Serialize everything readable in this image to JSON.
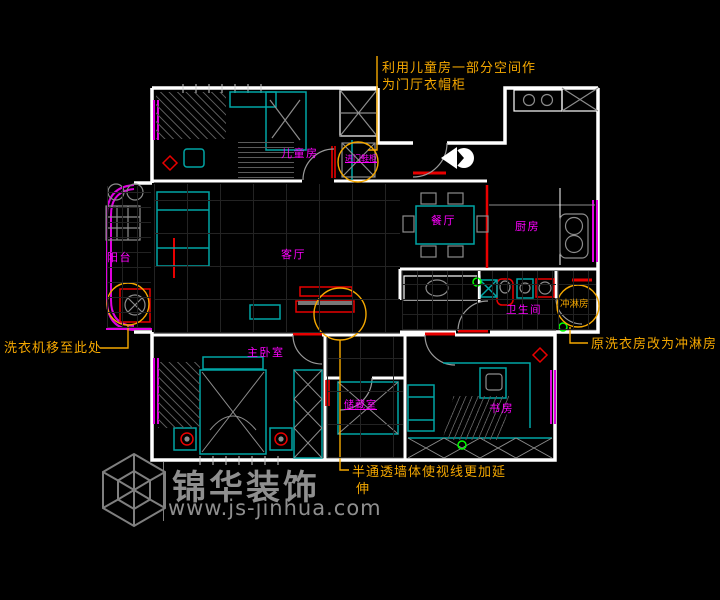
{
  "rooms": {
    "children": "儿童房",
    "shoe_cabinet": "进门鞋柜",
    "dining": "餐厅",
    "kitchen": "厨房",
    "living": "客厅",
    "balcony": "阳台",
    "master": "主卧室",
    "storage": "储藏室",
    "study": "书房",
    "bathroom": "卫生间",
    "shower": "冲淋房"
  },
  "annotations": {
    "wardrobe": {
      "line1": "利用儿童房一部分空间作",
      "line2": "为门厅衣帽柜"
    },
    "washer": "洗衣机移至此处",
    "shower_note": "原洗衣房改为冲淋房",
    "wall": {
      "line1": "半通透墙体使视线更加延",
      "line2": "伸"
    }
  },
  "watermark": {
    "brand": "锦华装饰",
    "url": "www.js-jinhua.com"
  },
  "colors": {
    "background": "#000000",
    "wall_white": "#ffffff",
    "furniture_cyan": "#00a5a5",
    "label_magenta": "#ff00ff",
    "window_magenta": "#e000e0",
    "annotation_orange": "#f5a800",
    "accent_red": "#e80000",
    "hatch_gray": "#8c8c8c",
    "marker_green": "#00ff00",
    "watermark_gray": "#9c9c9c"
  }
}
